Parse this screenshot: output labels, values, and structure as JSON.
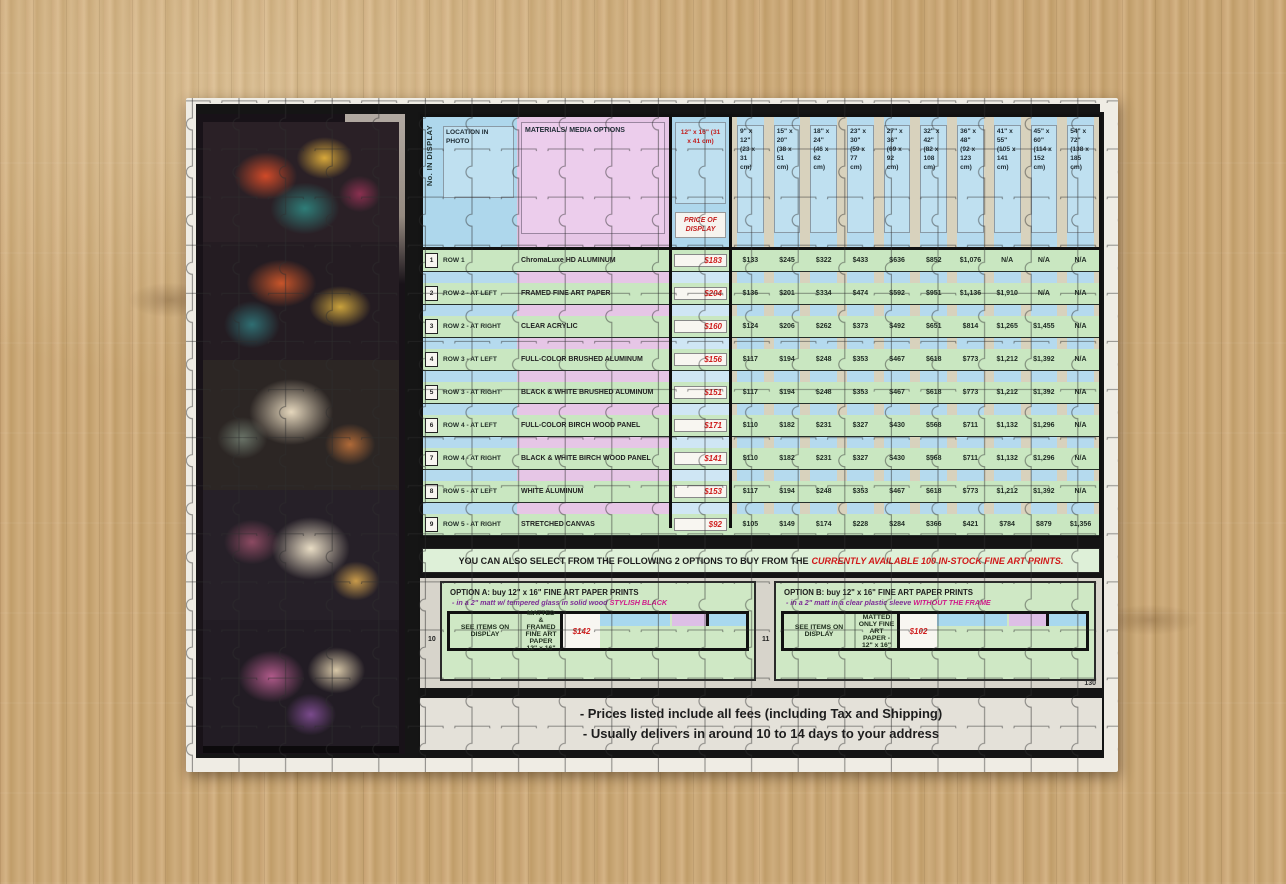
{
  "main": {
    "corner": "No. IN DISPLAY",
    "location_header": "LOCATION IN PHOTO",
    "materials_header": "MATERIALS/ MEDIA OPTIONS",
    "display_size": "12\" x 16\" (31 x 41 cm)",
    "price_header": "PRICE OF DISPLAY",
    "sizes": [
      "9\" x 12\" (23 x 31 cm)",
      "15\" x 20\" (38 x 51 cm)",
      "18\" x 24\" (46 x 62 cm)",
      "23\" x 30\" (59 x 77 cm)",
      "27\" x 36\" (69 x 92 cm)",
      "32\" x 42\" (82 x 108 cm)",
      "36\" x 48\" (92 x 123 cm)",
      "41\" x 55\" (105 x 141 cm)",
      "45\" x 60\" (114 x 152 cm)",
      "54\" x 72\" (138 x 185 cm)"
    ],
    "rows": [
      {
        "num": "1",
        "location": "ROW 1",
        "material": "ChromaLuxe HD ALUMINUM",
        "price": "$183",
        "values": [
          "$133",
          "$245",
          "$322",
          "$433",
          "$636",
          "$852",
          "$1,076",
          "N/A",
          "N/A",
          "N/A"
        ]
      },
      {
        "num": "2",
        "location": "ROW 2 - AT LEFT",
        "material": "FRAMED FINE ART PAPER",
        "price": "$204",
        "values": [
          "$136",
          "$201",
          "$334",
          "$474",
          "$592",
          "$951",
          "$1,136",
          "$1,910",
          "N/A",
          "N/A"
        ]
      },
      {
        "num": "3",
        "location": "ROW 2 - AT RIGHT",
        "material": "CLEAR ACRYLIC",
        "price": "$160",
        "values": [
          "$124",
          "$206",
          "$262",
          "$373",
          "$492",
          "$651",
          "$814",
          "$1,265",
          "$1,455",
          "N/A"
        ]
      },
      {
        "num": "4",
        "location": "ROW 3 - AT LEFT",
        "material": "FULL-COLOR BRUSHED ALUMINUM",
        "price": "$156",
        "values": [
          "$117",
          "$194",
          "$248",
          "$353",
          "$467",
          "$618",
          "$773",
          "$1,212",
          "$1,392",
          "N/A"
        ]
      },
      {
        "num": "5",
        "location": "ROW 3 - AT RIGHT",
        "material": "BLACK & WHITE BRUSHED ALUMINUM",
        "price": "$151",
        "values": [
          "$117",
          "$194",
          "$248",
          "$353",
          "$467",
          "$618",
          "$773",
          "$1,212",
          "$1,392",
          "N/A"
        ]
      },
      {
        "num": "6",
        "location": "ROW 4 - AT LEFT",
        "material": "FULL-COLOR BIRCH WOOD PANEL",
        "price": "$171",
        "values": [
          "$110",
          "$182",
          "$231",
          "$327",
          "$430",
          "$568",
          "$711",
          "$1,132",
          "$1,296",
          "N/A"
        ]
      },
      {
        "num": "7",
        "location": "ROW 4 - AT RIGHT",
        "material": "BLACK & WHITE BIRCH WOOD PANEL",
        "price": "$141",
        "values": [
          "$110",
          "$182",
          "$231",
          "$327",
          "$430",
          "$568",
          "$711",
          "$1,132",
          "$1,296",
          "N/A"
        ]
      },
      {
        "num": "8",
        "location": "ROW 5 - AT LEFT",
        "material": "WHITE ALUMINUM",
        "price": "$153",
        "values": [
          "$117",
          "$194",
          "$248",
          "$353",
          "$467",
          "$618",
          "$773",
          "$1,212",
          "$1,392",
          "N/A"
        ]
      },
      {
        "num": "9",
        "location": "ROW 5 - AT RIGHT",
        "material": "STRETCHED CANVAS",
        "price": "$92",
        "values": [
          "$105",
          "$149",
          "$174",
          "$228",
          "$284",
          "$366",
          "$421",
          "$784",
          "$879",
          "$1,356"
        ]
      }
    ]
  },
  "banner": {
    "text": "YOU CAN ALSO SELECT FROM THE FOLLOWING 2 OPTIONS TO BUY FROM THE",
    "highlight": "CURRENTLY AVAILABLE 100 IN-STOCK FINE ART PRINTS."
  },
  "optionA": {
    "num": "10",
    "title": "OPTION A: buy 12\" x 16\" FINE ART PAPER PRINTS",
    "sub": "- in a 2\" matt w/ tempered glass in solid wood ",
    "sub_hl": "STYLISH BLACK",
    "see": "SEE ITEMS ON DISPLAY",
    "desc": "MATTED & FRAMED FINE ART PAPER 12\" x 16\"",
    "price": "$142"
  },
  "optionB": {
    "num": "11",
    "title": "OPTION B: buy 12\" x 16\" FINE ART PAPER PRINTS",
    "sub": "- in a 2\" matt in a clear plastic sleeve ",
    "sub_hl": "WITHOUT THE FRAME",
    "see": "SEE ITEMS ON DISPLAY",
    "desc": "MATTED ONLY FINE ART PAPER - 12\" x 16\"",
    "price": "$102"
  },
  "pageno": "130",
  "notes": {
    "line1": "- Prices listed include all fees (including Tax and Shipping)",
    "line2": "- Usually delivers in around 10 to 14 days to your address"
  }
}
